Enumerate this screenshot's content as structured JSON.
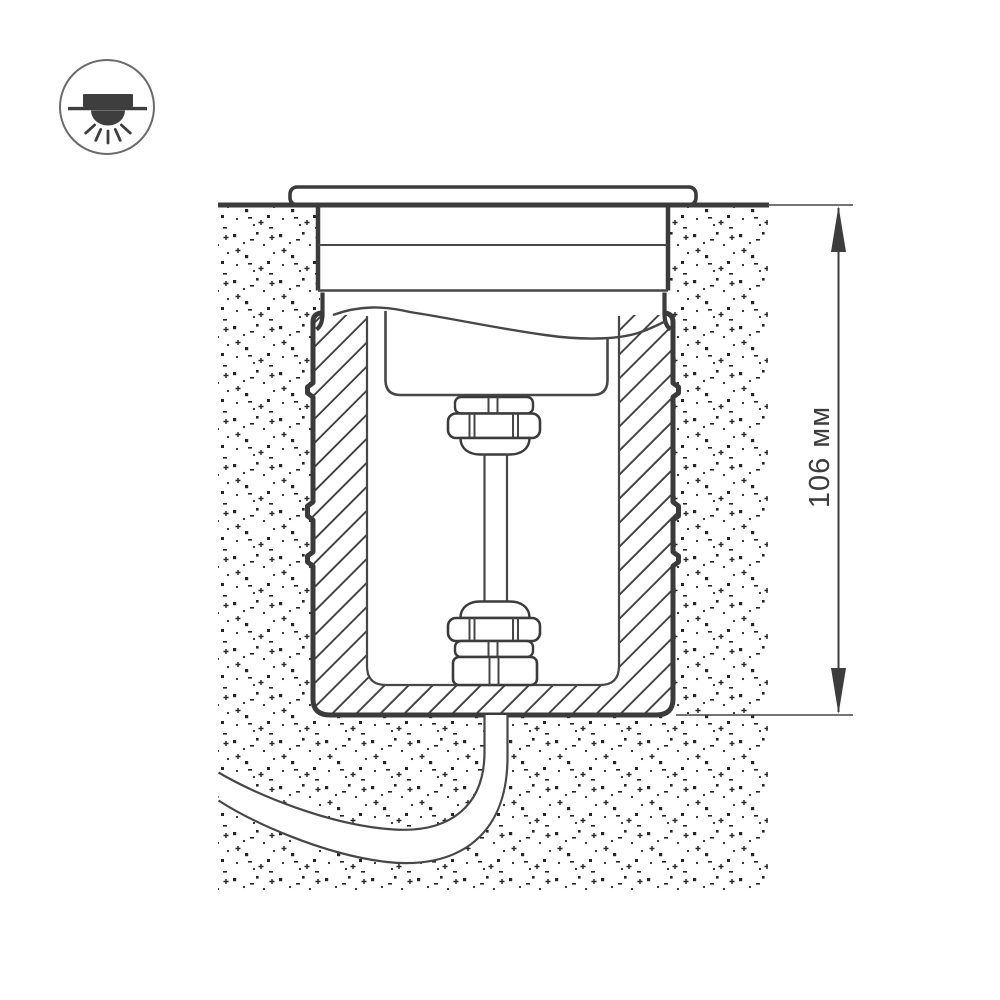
{
  "diagram": {
    "dimension": {
      "label": "106 мм",
      "value_mm": 106
    },
    "icon": {
      "name": "recessed-light-icon"
    },
    "colors": {
      "line": "#3b3b3b",
      "thin_line": "#474747",
      "dimension": "#3d3d3d",
      "background": "#ffffff",
      "icon_circle": "#6b6b6b",
      "icon_glyph": "#3e3e3e",
      "ground_dots": "#262626"
    },
    "textures": {
      "ground": "stipple-dots-texture",
      "embedding_sleeve": "diagonal-hatch-texture"
    }
  }
}
